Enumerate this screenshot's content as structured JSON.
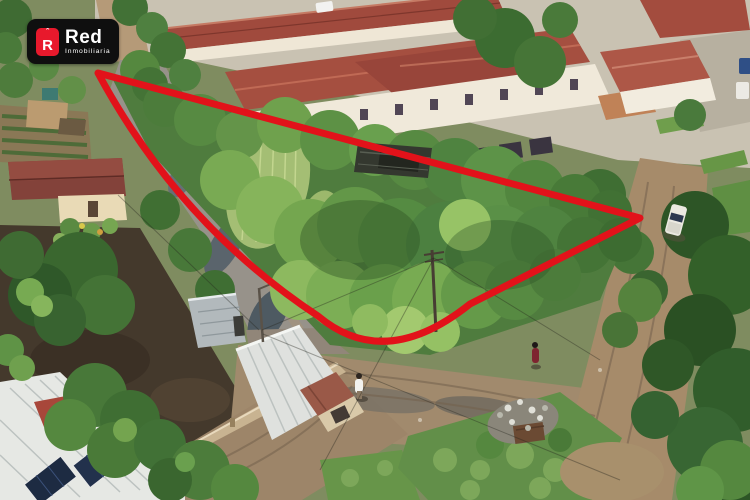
{
  "watermark": {
    "brand": "Red",
    "tagline": "Inmobiliaria",
    "icon_letter": "R",
    "icon_hat": "ˆ",
    "background_color": "#0f0f0f",
    "accent_color": "#e8192c",
    "text_color": "#ffffff"
  },
  "property_outline": {
    "color": "#e2121a",
    "stroke_width": 7,
    "path": "M 98 73 L 640 218 L 470 304 Q 385 372 318 316 Q 180 225 98 73 Z"
  },
  "scene": {
    "type": "aerial-drone-photo",
    "subject": "corner vacant lot with dense trees outlined in red",
    "visible_elements": [
      "residential complex with red tile roofs",
      "white two-story facades with windows",
      "muddy street with puddles",
      "dirt road intersection",
      "boundary wall",
      "metal roof buildings with solar panels",
      "white pickup truck",
      "pedestrian in white",
      "pedestrian in dark red",
      "trash pile",
      "utility pole and power lines"
    ]
  }
}
